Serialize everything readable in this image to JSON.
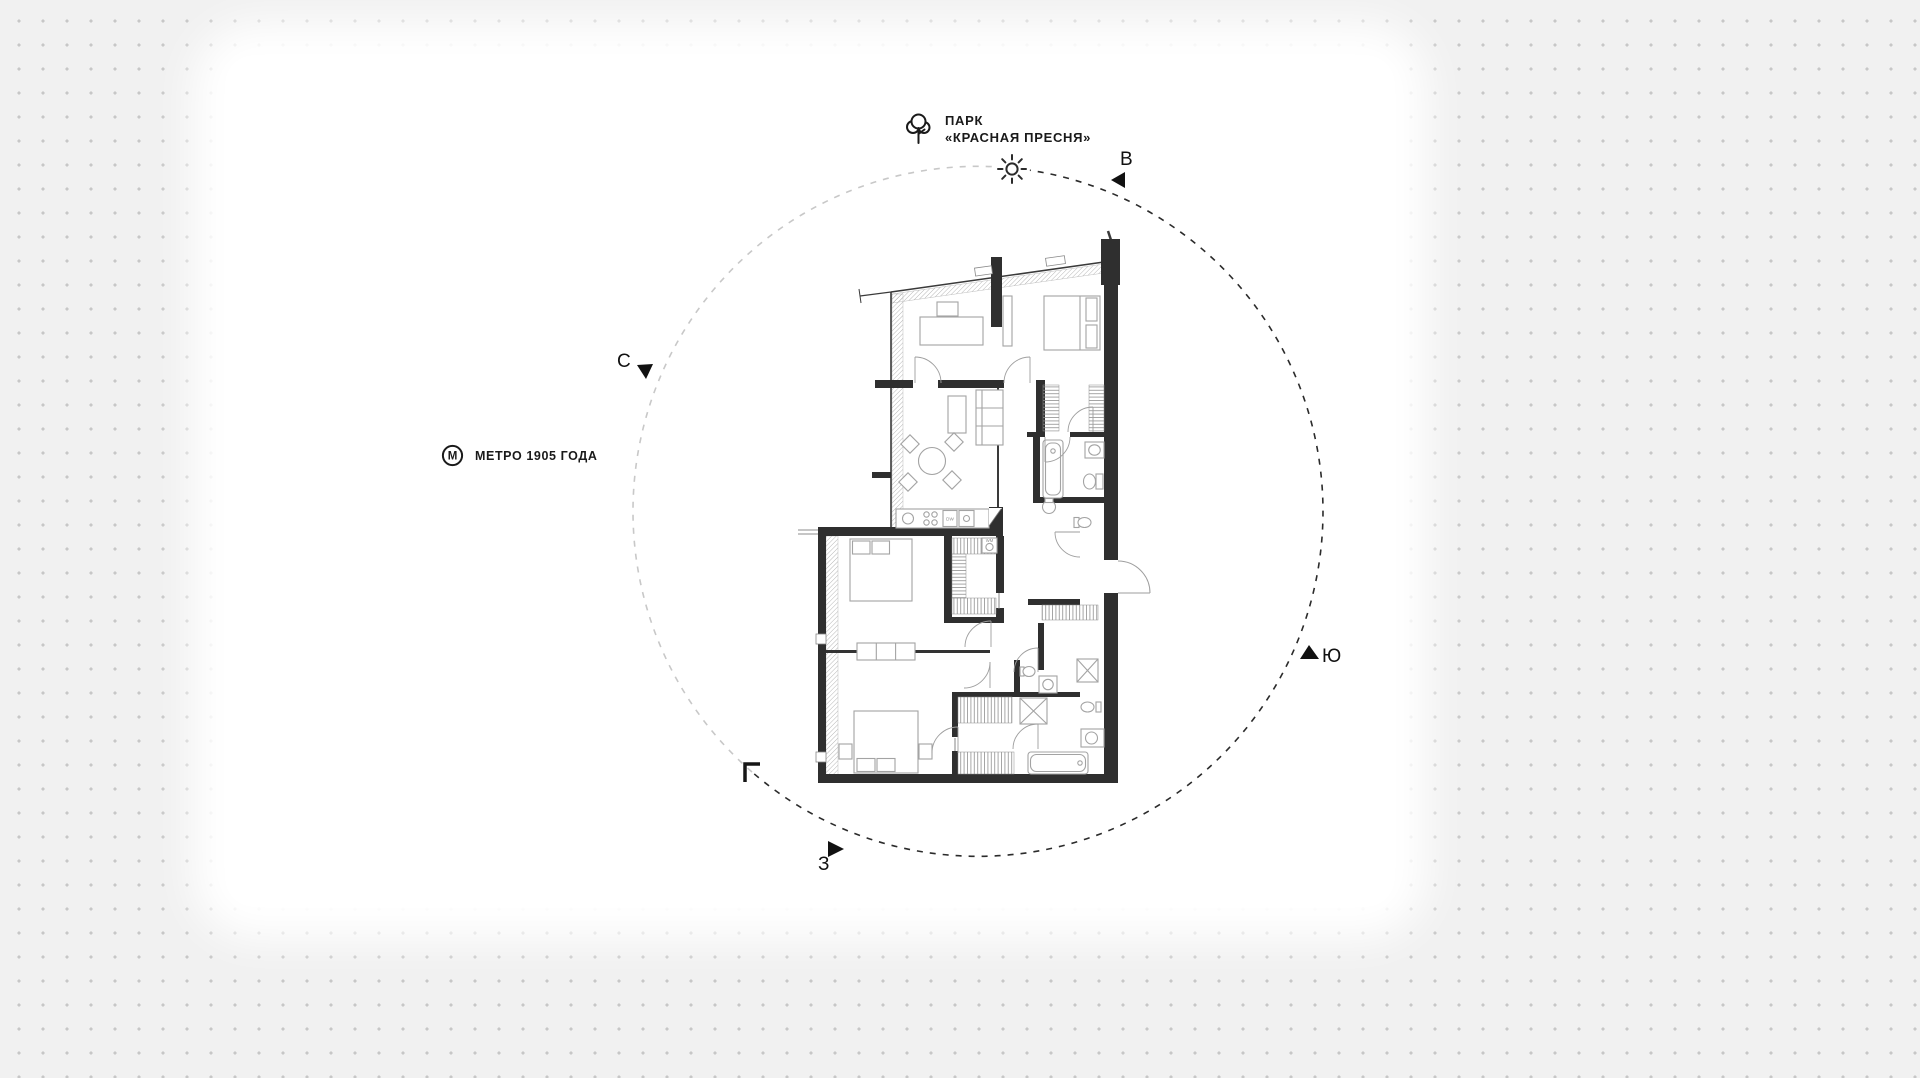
{
  "canvas": {
    "width": 1920,
    "height": 1078
  },
  "colors": {
    "background": "#f1f1f1",
    "dot": "#c7c7c7",
    "panel": "#ffffff",
    "ink": "#1a1a1a",
    "wall": "#2f2f2f",
    "furniture_line": "#a3a3a3",
    "circle_dark": "#2b2b2b",
    "circle_light": "#c8c8c8"
  },
  "landmarks": {
    "park": {
      "icon": "tree-icon",
      "line1": "ПАРК",
      "line2": "«КРАСНАЯ ПРЕСНЯ»"
    },
    "metro": {
      "icon": "metro-icon",
      "letter": "М",
      "label": "МЕТРО 1905 ГОДА"
    }
  },
  "compass": {
    "north": "С",
    "east": "В",
    "south": "Ю",
    "west": "З"
  },
  "plan": {
    "labels": {
      "dishwasher": "DW",
      "washer": "WM"
    }
  }
}
